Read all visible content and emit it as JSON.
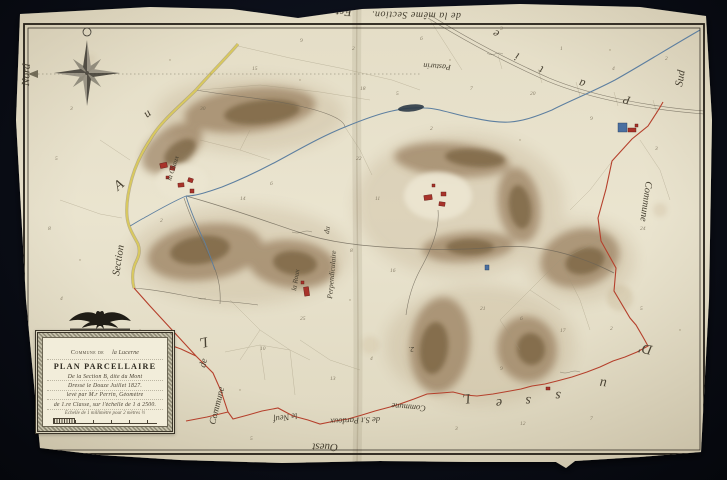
{
  "map": {
    "cartouche": {
      "line1_prefix": "Commune de",
      "line1_value": "la Lucerne",
      "title": "PLAN PARCELLAIRE",
      "line3": "De la Section B, dite du Mont",
      "line4": "Dressé le Douze Juillet 1827.",
      "line5": "levé par M.r Perrin, Géomètre",
      "line6": "de 1.re Classe, sur l'échelle de 1 à 2500.",
      "scale_note": "Échelle de 1 millimètre pour 2 mètres ½"
    },
    "labels": {
      "nord": "Nord",
      "est": "Est.",
      "top_edge": "de la même Section.",
      "sud": "Sud",
      "commune_right": "Commune",
      "ouest": "Ouest",
      "commune_left": "Commune",
      "de_left": "de",
      "letter_l": "L",
      "section": "Section",
      "letter_a": "A",
      "letter_u": "u",
      "pasturin": "Pasturin",
      "perpendiculaire": "Perpendiculaire",
      "du": "du",
      "la_roux": "la Roux",
      "la_chaux": "la Chaux",
      "bottom_commune": "Commune",
      "bottom_pardoux": "de S.t Pardoux",
      "bottom_neuf": "le Neuf",
      "num2": "2."
    },
    "spread_se": [
      "D'",
      "u",
      "s",
      "s",
      "e",
      "L"
    ],
    "spread_ne": [
      "P",
      "a",
      "t",
      "i",
      "e"
    ],
    "parcel_numbers": [
      {
        "t": "3",
        "x": 70,
        "y": 110
      },
      {
        "t": "5",
        "x": 55,
        "y": 160
      },
      {
        "t": "8",
        "x": 48,
        "y": 230
      },
      {
        "t": "4",
        "x": 60,
        "y": 300
      },
      {
        "t": "12",
        "x": 75,
        "y": 350
      },
      {
        "t": "7",
        "x": 95,
        "y": 392
      },
      {
        "t": "15",
        "x": 252,
        "y": 70
      },
      {
        "t": "9",
        "x": 300,
        "y": 42
      },
      {
        "t": "2",
        "x": 352,
        "y": 50
      },
      {
        "t": "6",
        "x": 420,
        "y": 40
      },
      {
        "t": "3",
        "x": 500,
        "y": 30
      },
      {
        "t": "1",
        "x": 560,
        "y": 50
      },
      {
        "t": "4",
        "x": 612,
        "y": 70
      },
      {
        "t": "2",
        "x": 665,
        "y": 60
      },
      {
        "t": "18",
        "x": 360,
        "y": 90
      },
      {
        "t": "5",
        "x": 396,
        "y": 95
      },
      {
        "t": "7",
        "x": 470,
        "y": 90
      },
      {
        "t": "20",
        "x": 530,
        "y": 95
      },
      {
        "t": "9",
        "x": 590,
        "y": 120
      },
      {
        "t": "3",
        "x": 655,
        "y": 150
      },
      {
        "t": "14",
        "x": 240,
        "y": 200
      },
      {
        "t": "6",
        "x": 270,
        "y": 185
      },
      {
        "t": "22",
        "x": 356,
        "y": 160
      },
      {
        "t": "11",
        "x": 375,
        "y": 200
      },
      {
        "t": "8",
        "x": 350,
        "y": 252
      },
      {
        "t": "16",
        "x": 390,
        "y": 272
      },
      {
        "t": "25",
        "x": 300,
        "y": 320
      },
      {
        "t": "10",
        "x": 260,
        "y": 350
      },
      {
        "t": "13",
        "x": 330,
        "y": 380
      },
      {
        "t": "4",
        "x": 370,
        "y": 360
      },
      {
        "t": "21",
        "x": 480,
        "y": 310
      },
      {
        "t": "6",
        "x": 520,
        "y": 320
      },
      {
        "t": "17",
        "x": 560,
        "y": 332
      },
      {
        "t": "2",
        "x": 610,
        "y": 330
      },
      {
        "t": "5",
        "x": 640,
        "y": 310
      },
      {
        "t": "9",
        "x": 500,
        "y": 370
      },
      {
        "t": "3",
        "x": 455,
        "y": 430
      },
      {
        "t": "12",
        "x": 520,
        "y": 425
      },
      {
        "t": "7",
        "x": 590,
        "y": 420
      },
      {
        "t": "5",
        "x": 250,
        "y": 440
      },
      {
        "t": "24",
        "x": 640,
        "y": 230
      },
      {
        "t": "2",
        "x": 430,
        "y": 130
      },
      {
        "t": "30",
        "x": 200,
        "y": 110
      },
      {
        "t": "2",
        "x": 160,
        "y": 222
      }
    ],
    "colors": {
      "paper": "#e8e2cc",
      "ink": "#3f3a2e",
      "boundary_red": "#b5402c",
      "road_yellow": "#d9c95e",
      "water_blue": "#5d7fa0",
      "terrain_sepia": "#7b5a38",
      "building_red": "#a8332a",
      "background": "#0b0e18"
    }
  }
}
